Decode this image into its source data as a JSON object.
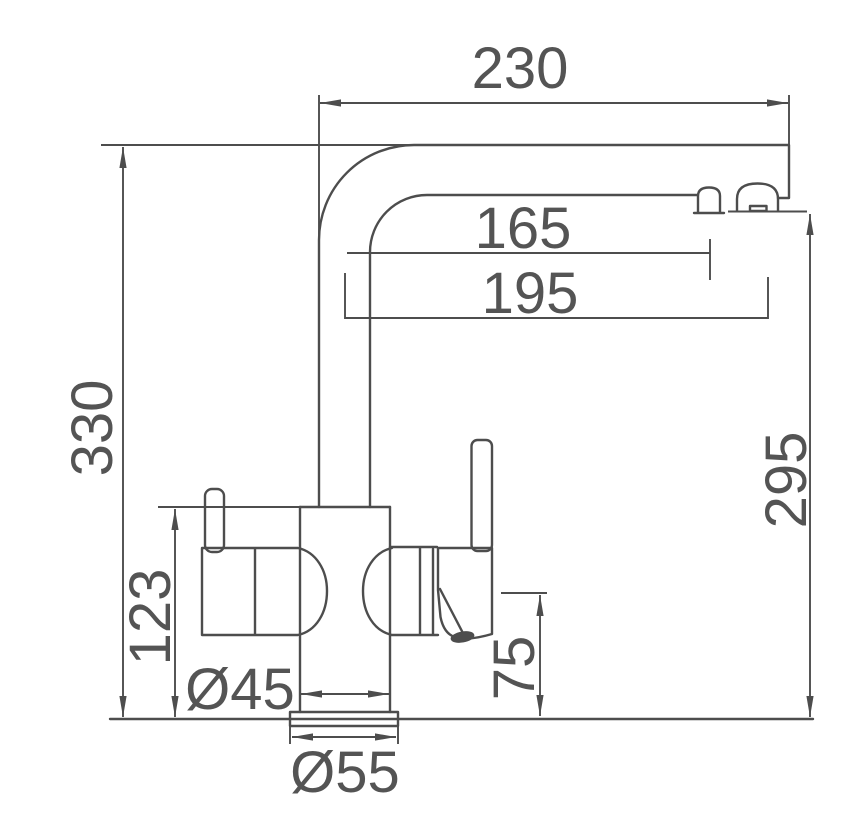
{
  "drawing": {
    "subject": "kitchen-mixer-faucet-side-elevation",
    "unit": "mm",
    "background_color": "#ffffff",
    "line_color": "#4d4d4d",
    "text_color": "#545454",
    "dimensions": {
      "spout_reach": "230",
      "aerator_offset": "165",
      "spout_tip_offset": "195",
      "overall_height": "330",
      "body_height": "123",
      "outlet_height": "295",
      "handle_base_height": "75",
      "body_diameter": "Ø45",
      "base_diameter": "Ø55"
    }
  }
}
